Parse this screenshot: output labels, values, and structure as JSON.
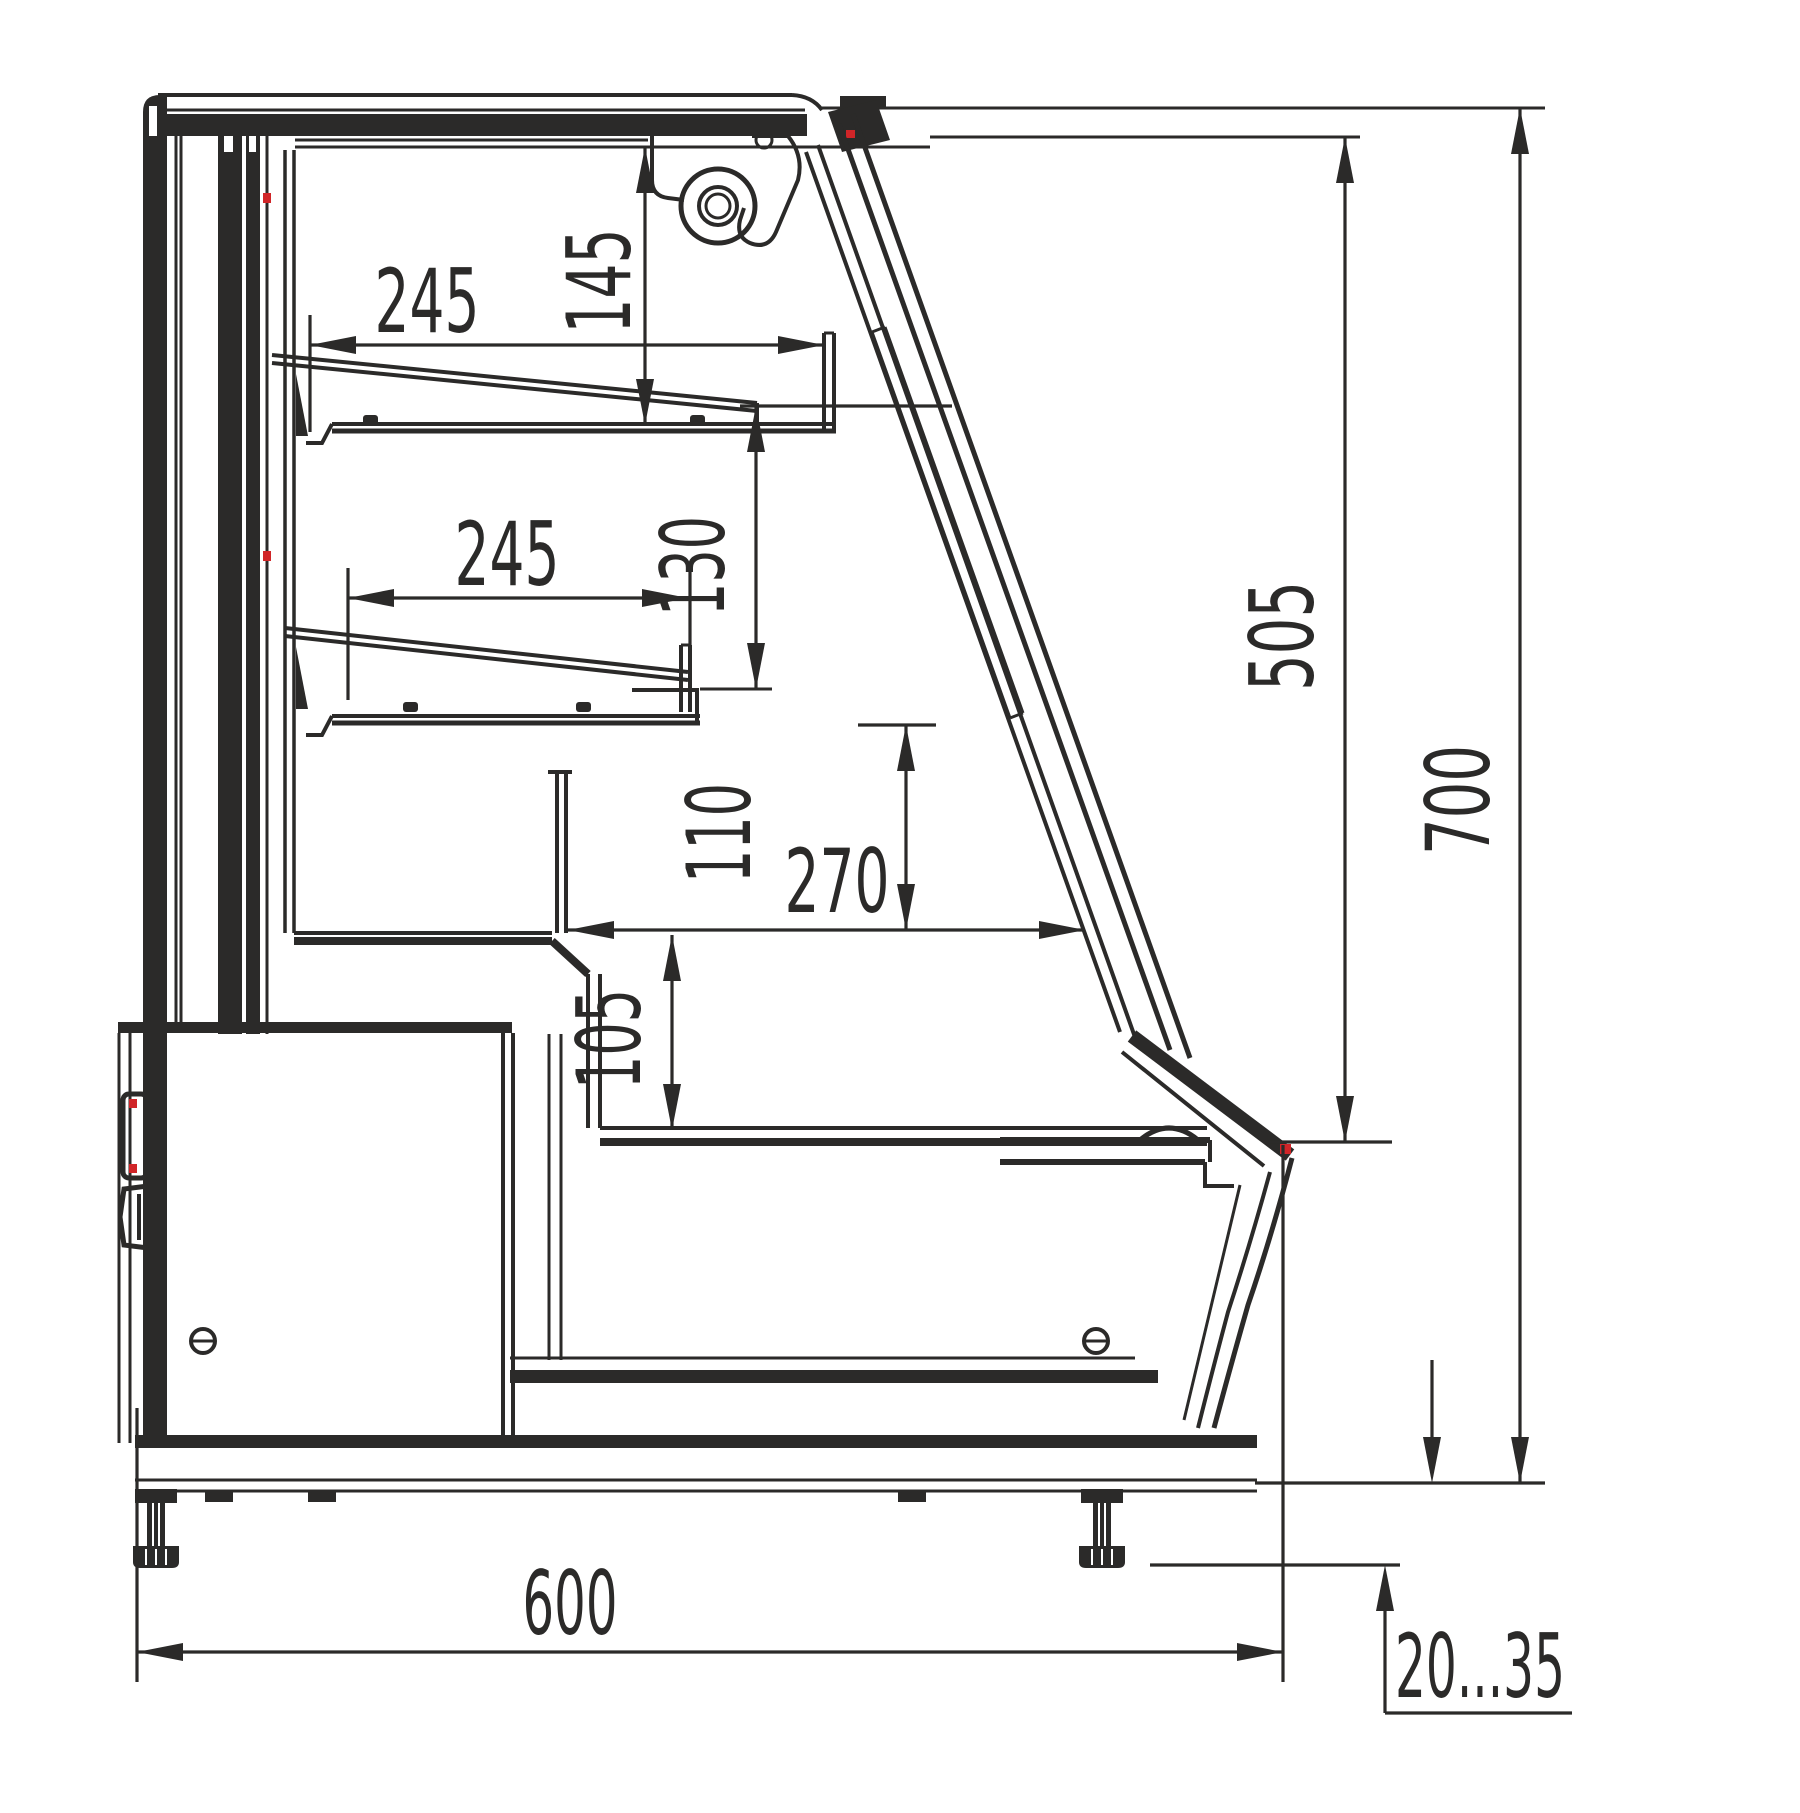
{
  "drawing": {
    "type": "technical-section-drawing",
    "subject": "display-case-side-cross-section",
    "colors": {
      "line": "#2b2a29",
      "accent": "#d02528",
      "background": "#ffffff"
    },
    "dimensions": {
      "shelf_top_depth": {
        "value": "245"
      },
      "shelf_top_clearance": {
        "value": "145"
      },
      "shelf_low_depth": {
        "value": "245"
      },
      "shelf_low_clearance": {
        "value": "130"
      },
      "well_clearance": {
        "value": "110"
      },
      "well_depth": {
        "value": "270"
      },
      "well_height": {
        "value": "105"
      },
      "glass_height": {
        "value": "505"
      },
      "total_height": {
        "value": "700"
      },
      "total_depth": {
        "value": "600"
      },
      "foot_adjust_range": {
        "value": "20...35"
      }
    }
  }
}
